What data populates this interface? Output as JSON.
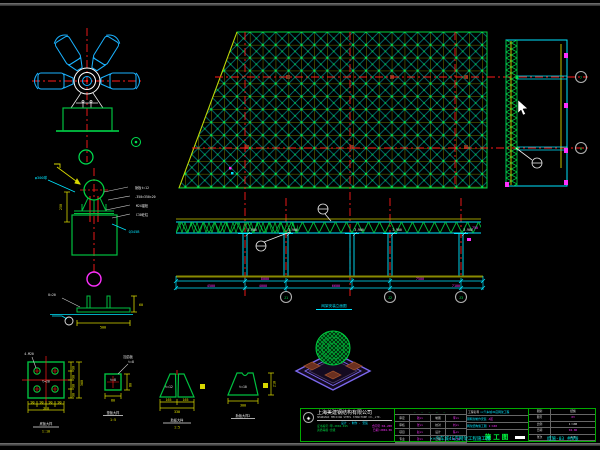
{
  "section": {
    "bubble_top": "7",
    "bubble_bottom": "8"
  },
  "elevation": {
    "caption": "网架安装立面图",
    "bubbles": [
      "J1",
      "J2",
      "J3"
    ],
    "levels": [
      "3.900",
      "3.900",
      "3.900",
      "3.900",
      "3.900"
    ],
    "dims_row1": [
      "8000",
      "7500"
    ],
    "dims_row2": [
      "4500",
      "4000",
      "6600",
      "7100"
    ],
    "dim_right": "750"
  },
  "support": {
    "label_left": "φ300球",
    "labels": [
      "肋板t=12",
      "-350×350×20",
      "M24锚栓",
      "C30砼柱"
    ],
    "label_right": "Q345B",
    "dim": "250"
  },
  "detail_section": {
    "leader": "δ=20",
    "dim_right": "60",
    "dim_bottom": "500"
  },
  "base_plate": {
    "leader": "4-M20",
    "center": "t=20",
    "dim_side": "90",
    "dim_side_total": "360",
    "dims_bottom": [
      "90",
      "90",
      "90",
      "90"
    ],
    "dim_bottom_total": "360",
    "caption": "底板大样",
    "scale": "1:10"
  },
  "pad_plate": {
    "leader1": "加劲板",
    "leader2": "t=8",
    "center": "t=8",
    "dim_right": "80",
    "dim_bottom": "80",
    "caption": "垫板大样",
    "scale": "1:5"
  },
  "rib_pair": {
    "thickness": "t=12",
    "dim_half_1": "165",
    "dim_half_2": "165",
    "dim_total": "330",
    "caption": "肋板大样",
    "scale": "1:5"
  },
  "rib_single": {
    "thickness": "t=10",
    "dim_bottom": "300",
    "dim_right": "210",
    "caption": "肋板大样2"
  },
  "titleblock": {
    "logo_glyph": "◈",
    "company_cn": "上海美建钢结构有限公司",
    "company_en": "SHANGHAI MEIJIAN STEEL STRUCTURE CO.,LTD.",
    "slogan": "设计 · 制作 · 安装",
    "cert_left1": "证书编号:甲-2004-015",
    "cert_right1": "合同号:04-208",
    "cert_left2": "资质等级:壹级",
    "cert_right2": "日期:2004.06",
    "header_dashes": "— — — — —",
    "sign_rows": [
      [
        "审定",
        "钱××",
        "制图",
        "李××"
      ],
      [
        "审核",
        "张××",
        "校对",
        "刘××"
      ],
      [
        "项目",
        "赵××",
        "设计",
        "陈××"
      ],
      [
        "专业",
        "孙××",
        "日期",
        "04.06"
      ]
    ],
    "project_label": "工程名称",
    "project_value": "××汽车城4S店网架工程",
    "item_row1": "钢网架制作安装",
    "item_row1b": "A区",
    "item_row2": "网架结构施工图",
    "item_row2b": "1:100",
    "stage": "施工图",
    "info_rows": [
      [
        "图别",
        "结施"
      ],
      [
        "图号",
        "03"
      ],
      [
        "比例",
        "1:100"
      ],
      [
        "日期",
        "04.06"
      ],
      [
        "张次",
        "2/8"
      ]
    ]
  },
  "footer": {
    "left": "××汽车城4S店网架工程施工图",
    "right": "结施-03 共8张"
  },
  "colors": {
    "grid_green": "#00c040",
    "cyan": "#00e5ff",
    "red": "#ff1a1a",
    "magenta": "#ff30ff",
    "yellow": "#e0e000",
    "olive": "#8a9a00"
  }
}
